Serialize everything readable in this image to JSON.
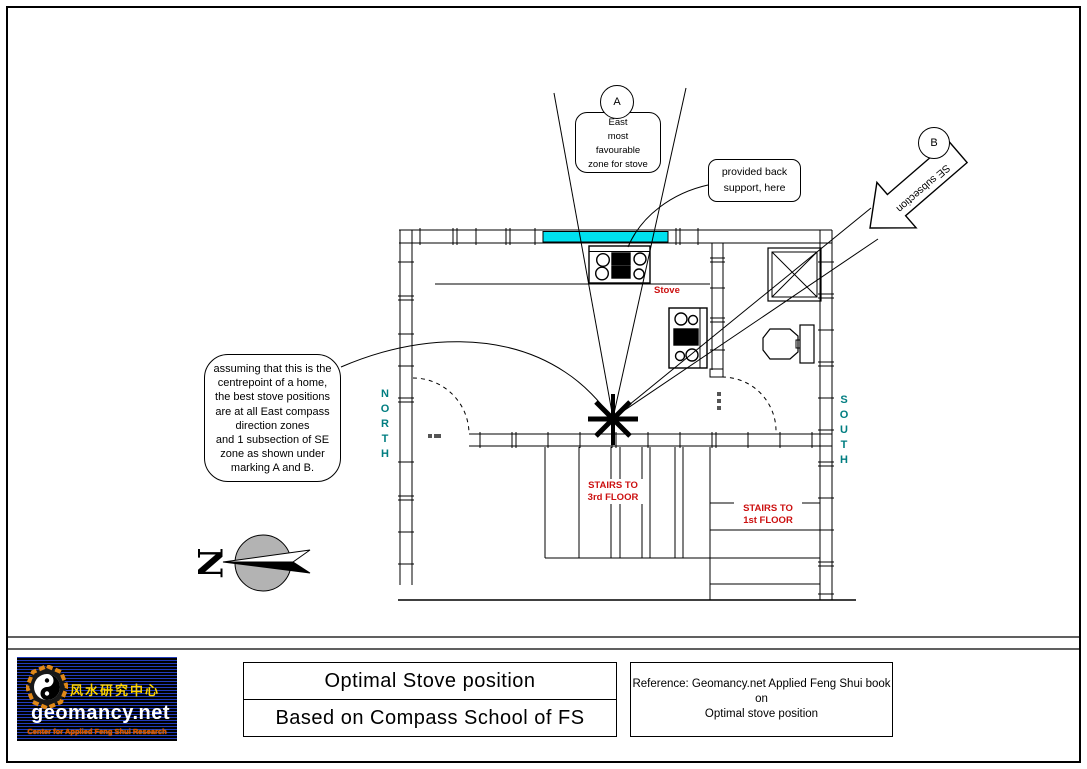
{
  "plan": {
    "marker_a": "A",
    "marker_b": "B",
    "zone_note": "East\nmost\nfavourable\nzone for stove",
    "arrow_label": "SE subsection",
    "support_note": "provided back\nsupport, here",
    "center_note": "assuming that this is the\ncentrepoint of a home,\nthe best stove positions\nare at all East compass\ndirection zones\nand 1 subsection of SE\nzone as shown under\nmarking A and B.",
    "north": "NORTH",
    "south": "SOUTH",
    "stove": "Stove",
    "stairs_3rd": "STAIRS TO\n3rd FLOOR",
    "stairs_1st": "STAIRS TO\n1st FLOOR",
    "compass_letter": "N",
    "colors": {
      "counter_highlight": "#00e1ef",
      "label_red": "#cc1111",
      "direction_teal": "#007d80"
    }
  },
  "titleblock": {
    "line1": "Optimal Stove position",
    "line2": "Based on Compass School of FS",
    "reference": "Reference: Geomancy.net Applied Feng Shui book on\nOptimal stove position"
  },
  "logo": {
    "chinese": "风水研究中心",
    "domain": "geomancy.net",
    "tagline": "Center for Applied Feng Shui Research"
  }
}
